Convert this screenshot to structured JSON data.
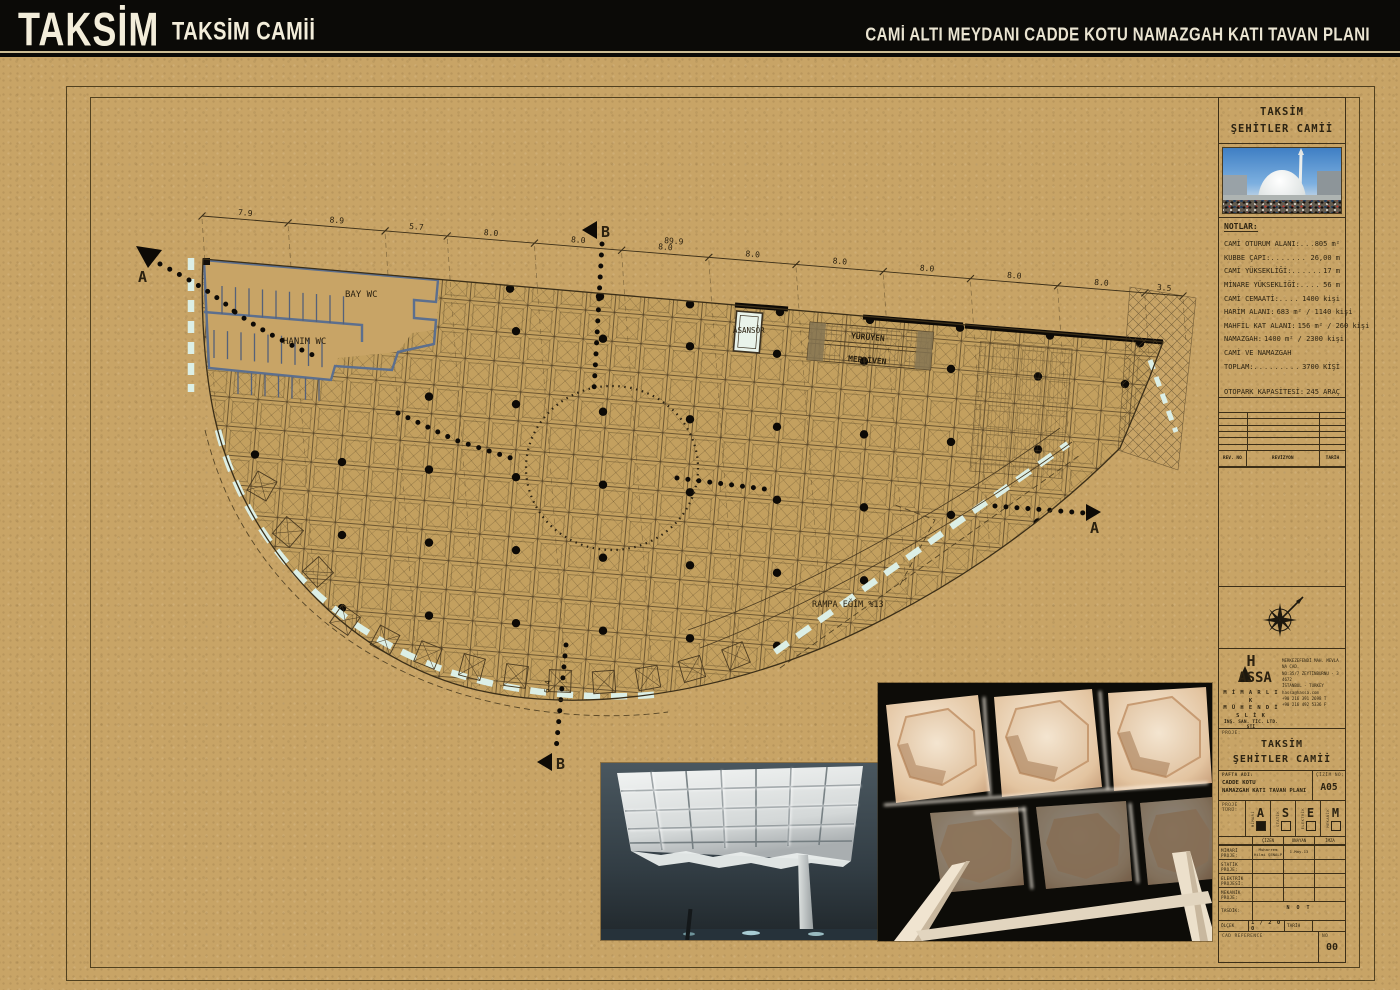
{
  "header": {
    "logo": "TAKSİM",
    "logo_subtitle": "TAKSİM CAMİİ",
    "sheet_title": "CAMİ ALTI  MEYDANI CADDE KOTU NAMAZGAH KATI TAVAN PLANI"
  },
  "title_block": {
    "project_name_line1": "TAKSİM",
    "project_name_line2": "ŞEHİTLER CAMİİ",
    "notes_title": "NOTLAR:",
    "notes": [
      {
        "label": "CAMİ OTURUM ALANI",
        "value": "805 m²"
      },
      {
        "label": "KUBBE ÇAPI",
        "value": "26,00 m"
      },
      {
        "label": "CAMİ YÜKSEKLİĞİ",
        "value": "17 m"
      },
      {
        "label": "MİNARE YÜKSEKLİĞİ",
        "value": "56 m"
      },
      {
        "label": "CAMİ CEMAATİ",
        "value": "1400 kişi"
      },
      {
        "label": "HARİM ALANI",
        "value": "683 m² / 1140 kişi"
      },
      {
        "label": "MAHFİL KAT ALANI",
        "value": "156 m² / 260 kişi"
      },
      {
        "label": "NAMAZGAH",
        "value": "1400 m² / 2300 kişi"
      },
      {
        "label": "CAMİ VE NAMAZGAH",
        "value": ""
      },
      {
        "label": "TOPLAM",
        "value": "3700 KİŞİ"
      },
      {
        "label": "OTOPARK KAPASİTESİ",
        "value": "245 ARAÇ"
      }
    ],
    "revision": {
      "headers": [
        "REV. NO",
        "REVİZYON",
        "TARİH"
      ],
      "empty_rows": 6
    },
    "firm": {
      "brand_h": "H",
      "brand_assa": "ASSA",
      "name1": "M İ M A R L I K",
      "name2": "M Ü H E N D İ S L İ K",
      "name3": "İNŞ. SAN. TİC. LTD. ŞTİ",
      "address": [
        "MERKEZEFENDİ MAH. MEVLANA CAD.",
        "NO:35/7 ZEYTİNBURNU - 34672",
        "İSTANBUL - TURKEY",
        "hassa@hassa.com",
        "+90 216 391 2698 T",
        "+90 216 492 5336 F"
      ]
    },
    "proje_label": "PROJE:",
    "pafta_label": "PAFTA ADI:",
    "pafta_line1": "CADDE KOTU",
    "pafta_line2": "NAMAZGAH KATI TAVAN PLANI",
    "cizim_label": "ÇİZİM NO:",
    "cizim_no": "A05",
    "proje_turu_label": "PROJE TÜRÜ:",
    "proje_turu": [
      {
        "code": "A",
        "name": "MİMARİ",
        "checked": true
      },
      {
        "code": "S",
        "name": "STATİK",
        "checked": false
      },
      {
        "code": "E",
        "name": "ELEKTRİK",
        "checked": false
      },
      {
        "code": "M",
        "name": "MEKANİK",
        "checked": false
      }
    ],
    "sig_headers": [
      "ÇİZEN",
      "ONAYAN",
      "İMZA"
    ],
    "sig_rows": [
      {
        "label": "MİMARİ PROJE:",
        "cells": [
          "Muharrem Hilmi ŞENALP",
          "1.May.13",
          ""
        ]
      },
      {
        "label": "STATİK PROJE:",
        "cells": [
          "",
          "",
          ""
        ]
      },
      {
        "label": "ELEKTRİK PROJESİ:",
        "cells": [
          "",
          "",
          ""
        ]
      },
      {
        "label": "MEKANİK PROJE:",
        "cells": [
          "",
          "",
          ""
        ]
      }
    ],
    "tasdik_label": "TASDİK:",
    "tasdik_value": "N O T",
    "olcek_label": "ÖLÇEK",
    "olcek_value": "1 / 2 0 0",
    "tarih_label": "TARİH",
    "cad_label": "CAD REFERENCE",
    "no_label": "NO",
    "rev_no": "00"
  },
  "plan": {
    "labels": {
      "bay_wc": "BAY WC",
      "hanim_wc": "HANIM WC",
      "asansor": "ASANSÖR",
      "yuruyen": "YÜRÜYEN",
      "merdiven": "MERDİVEN",
      "rampa": "RAMPA EĞİM %13",
      "section_a": "A",
      "section_b": "B",
      "dim_small": "6.4"
    },
    "dimensions": {
      "segments": [
        "7.9",
        "8.9",
        "5.7",
        "8.0",
        "8.0",
        "8.0",
        "8.0",
        "8.0",
        "8.0",
        "8.0",
        "8.0",
        "3.5"
      ],
      "total": "89.9"
    }
  },
  "colors": {
    "paper": "#c8a466",
    "ink": "#3a2e18",
    "wall_blue": "#5c6f8e",
    "curb": "#dcefe6",
    "header_bg": "#0b0a07",
    "header_text": "#f2ecd9"
  }
}
